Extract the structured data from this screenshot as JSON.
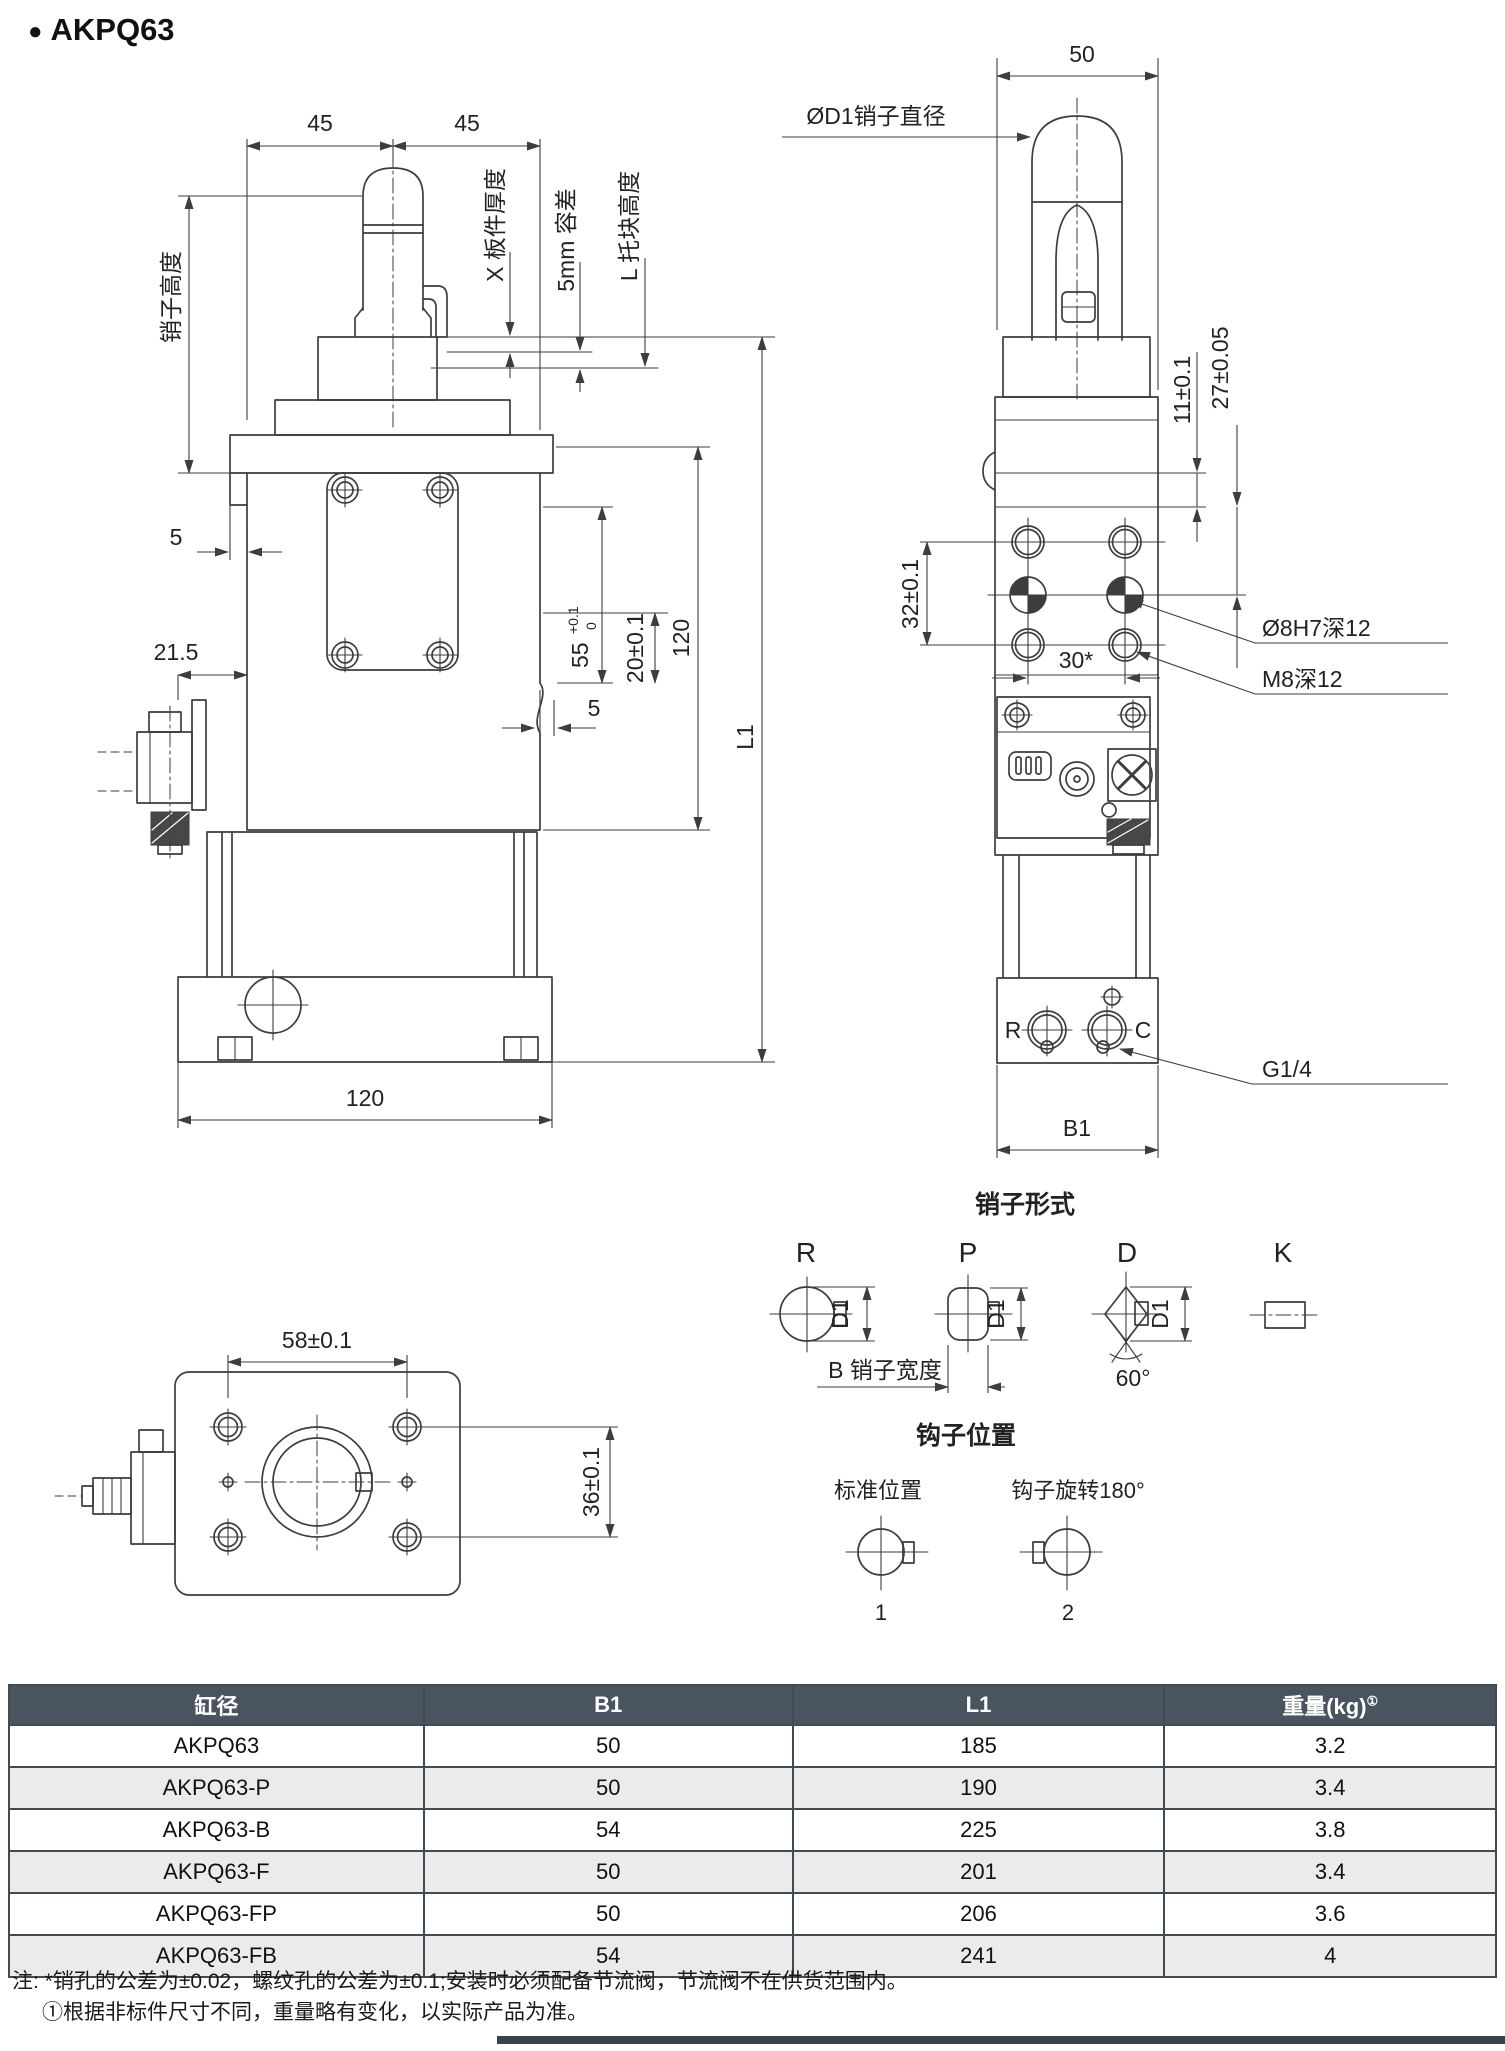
{
  "page": {
    "bullet": "●",
    "title": "AKPQ63"
  },
  "colors": {
    "line": "#3d3d3d",
    "table_header_bg": "#4a545e",
    "table_row_alt_bg": "#ebebeb",
    "table_border": "#3f4a52",
    "footer_bar": "#3a424a"
  },
  "front_view": {
    "dim_45_left": "45",
    "dim_45_right": "45",
    "label_pin_height": "销子高度",
    "label_plate_thickness": "X 板件厚度",
    "label_tolerance": "5mm 容差",
    "label_block_height": "L 托块高度",
    "dim_5_left": "5",
    "dim_21_5": "21.5",
    "dim_55": "55",
    "dim_55_upper": "+0.1",
    "dim_55_lower": "0",
    "dim_20": "20±0.1",
    "dim_120_vertical": "120",
    "dim_l1": "L1",
    "dim_5_right": "5",
    "dim_120_bottom": "120"
  },
  "side_view": {
    "dim_50": "50",
    "label_pin_dia": "ØD1销子直径",
    "dim_11": "11±0.1",
    "dim_27": "27±0.05",
    "dim_32": "32±0.1",
    "dim_30": "30*",
    "label_hole": "Ø8H7深12",
    "label_thread": "M8深12",
    "label_port": "G1/4",
    "port_r": "R",
    "port_c": "C",
    "dim_b1": "B1"
  },
  "pin_forms": {
    "title": "销子形式",
    "type_r": "R",
    "type_p": "P",
    "type_d": "D",
    "type_k": "K",
    "d1_r": "D1",
    "d1_p": "D1",
    "d1_d": "D1",
    "width_label": "B 销子宽度",
    "angle": "60°"
  },
  "hook_positions": {
    "title": "钩子位置",
    "standard": "标准位置",
    "rotated": "钩子旋转180°",
    "pos1": "1",
    "pos2": "2"
  },
  "bottom_view": {
    "dim_58": "58±0.1",
    "dim_36": "36±0.1"
  },
  "table": {
    "headers": [
      "缸径",
      "B1",
      "L1",
      "重量(kg)"
    ],
    "header_sup": "①",
    "rows": [
      {
        "model": "AKPQ63",
        "b1": "50",
        "l1": "185",
        "weight": "3.2"
      },
      {
        "model": "AKPQ63-P",
        "b1": "50",
        "l1": "190",
        "weight": "3.4"
      },
      {
        "model": "AKPQ63-B",
        "b1": "54",
        "l1": "225",
        "weight": "3.8"
      },
      {
        "model": "AKPQ63-F",
        "b1": "50",
        "l1": "201",
        "weight": "3.4"
      },
      {
        "model": "AKPQ63-FP",
        "b1": "50",
        "l1": "206",
        "weight": "3.6"
      },
      {
        "model": "AKPQ63-FB",
        "b1": "54",
        "l1": "241",
        "weight": "4"
      }
    ]
  },
  "notes": {
    "line1": "注: *销孔的公差为±0.02，螺纹孔的公差为±0.1;安装时必须配备节流阀，节流阀不在供货范围内。",
    "line2": "①根据非标件尺寸不同，重量略有变化，以实际产品为准。"
  }
}
